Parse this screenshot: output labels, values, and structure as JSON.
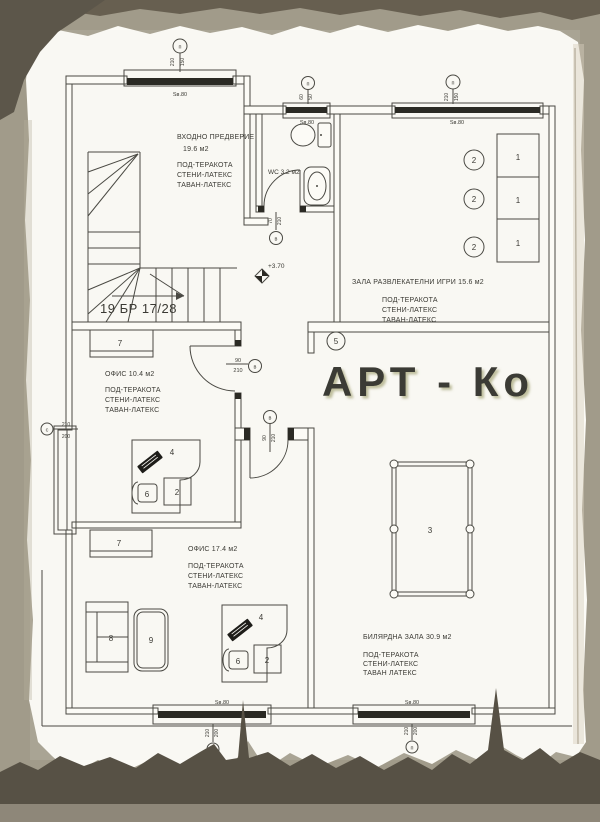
{
  "watermark": {
    "text": "АРТ - Ко",
    "color": "#e4e4a2"
  },
  "colors": {
    "paper": "#fcfbf6",
    "ink": "#4a4943",
    "scan_background": "#a19b8a",
    "watermark": "#e4e4a2"
  },
  "stairs": {
    "label": "19 БР 17/28"
  },
  "elevation": {
    "label": "+3.70"
  },
  "rooms": {
    "vestibule": {
      "name": "ВХОДНО ПРЕДВЕРИЕ",
      "area": "19.6 м2",
      "fin": [
        "ПОД-ТЕРАКОТА",
        "СТЕНИ-ЛАТЕКС",
        "ТАВАН-ЛАТЕКС"
      ]
    },
    "wc": {
      "label": "WC 3.2 м2"
    },
    "games": {
      "label": "ЗАЛА РАЗВЛЕКАТЕЛНИ ИГРИ 15.6 м2",
      "fin": [
        "ПОД-ТЕРАКОТА",
        "СТЕНИ-ЛАТЕКС",
        "ТАВАН-ЛАТЕКС"
      ]
    },
    "office1": {
      "label": "ОФИС 10.4 м2",
      "fin": [
        "ПОД-ТЕРАКОТА",
        "СТЕНИ-ЛАТЕКС",
        "ТАВАН-ЛАТЕКС"
      ]
    },
    "office2": {
      "label": "ОФИС 17.4 м2",
      "fin": [
        "ПОД-ТЕРАКОТА",
        "СТЕНИ-ЛАТЕКС",
        "ТАВАН-ЛАТЕКС"
      ]
    },
    "billiard": {
      "label": "БИЛЯРДНА ЗАЛА 30.9 м2",
      "fin": [
        "ПОД-ТЕРАКОТА",
        "СТЕНИ-ЛАТЕКС",
        "ТАВАН ЛАТЕКС"
      ]
    }
  },
  "marks": {
    "m1": "1",
    "m2": "2",
    "m3": "3",
    "m4": "4",
    "m5": "5",
    "m6": "6",
    "m7": "7",
    "m8": "8",
    "m9": "9"
  },
  "openings": {
    "windows": [
      {
        "id": "top-left",
        "mark": "п",
        "dim1": "210",
        "dim2": "150",
        "sill": "Sв.80"
      },
      {
        "id": "wc",
        "mark": "п",
        "dim1": "60",
        "dim2": "50",
        "sill": "Sв.80"
      },
      {
        "id": "games-hall",
        "mark": "п",
        "dim1": "210",
        "dim2": "150",
        "sill": "Sв.80"
      },
      {
        "id": "left",
        "mark": "с",
        "dim1": "210",
        "dim2": "200"
      },
      {
        "id": "bottom-left",
        "mark": "п",
        "dim1": "210",
        "dim2": "200",
        "sill": "Sв.80"
      },
      {
        "id": "bottom-right",
        "mark": "п",
        "dim1": "210",
        "dim2": "200",
        "sill": "Sв.80"
      }
    ],
    "doors": [
      {
        "id": "wc",
        "mark": "в",
        "dim1": "70",
        "dim2": "210"
      },
      {
        "id": "office1",
        "mark": "в",
        "dim1": "90",
        "dim2": "210"
      },
      {
        "id": "office2",
        "mark": "в",
        "dim1": "90",
        "dim2": "210"
      }
    ]
  }
}
